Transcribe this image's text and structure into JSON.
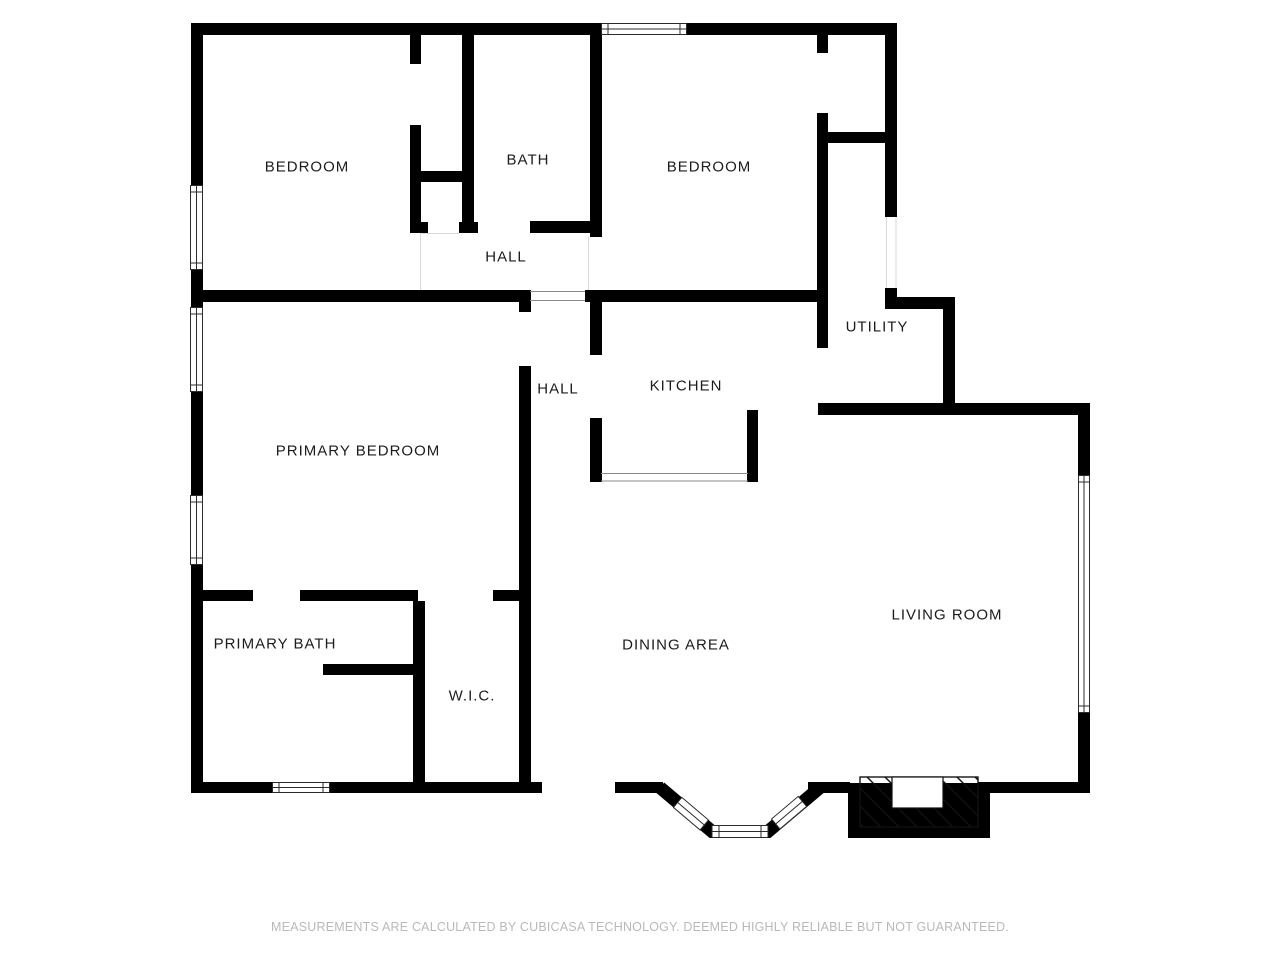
{
  "plan": {
    "rooms": [
      {
        "id": "bedroom-left",
        "label": "BEDROOM"
      },
      {
        "id": "bath",
        "label": "BATH"
      },
      {
        "id": "bedroom-right",
        "label": "BEDROOM"
      },
      {
        "id": "hall-upper",
        "label": "HALL"
      },
      {
        "id": "utility",
        "label": "UTILITY"
      },
      {
        "id": "hall-lower",
        "label": "HALL"
      },
      {
        "id": "kitchen",
        "label": "KITCHEN"
      },
      {
        "id": "primary-bedroom",
        "label": "PRIMARY BEDROOM"
      },
      {
        "id": "primary-bath",
        "label": "PRIMARY BATH"
      },
      {
        "id": "wic",
        "label": "W.I.C."
      },
      {
        "id": "dining-area",
        "label": "DINING AREA"
      },
      {
        "id": "living-room",
        "label": "LIVING ROOM"
      }
    ],
    "footer": {
      "disclaimer": "MEASUREMENTS ARE CALCULATED BY CUBICASA TECHNOLOGY. DEEMED HIGHLY RELIABLE BUT NOT GUARANTEED."
    },
    "colors": {
      "background": "#ffffff",
      "wall": "#000000",
      "window_outline": "#2b2b2b",
      "open_boundary_line": "#8a8a8a",
      "faint_line": "#d9d9d9",
      "label_text": "#1c1c1c",
      "footer_text": "#b9b9b9"
    }
  }
}
